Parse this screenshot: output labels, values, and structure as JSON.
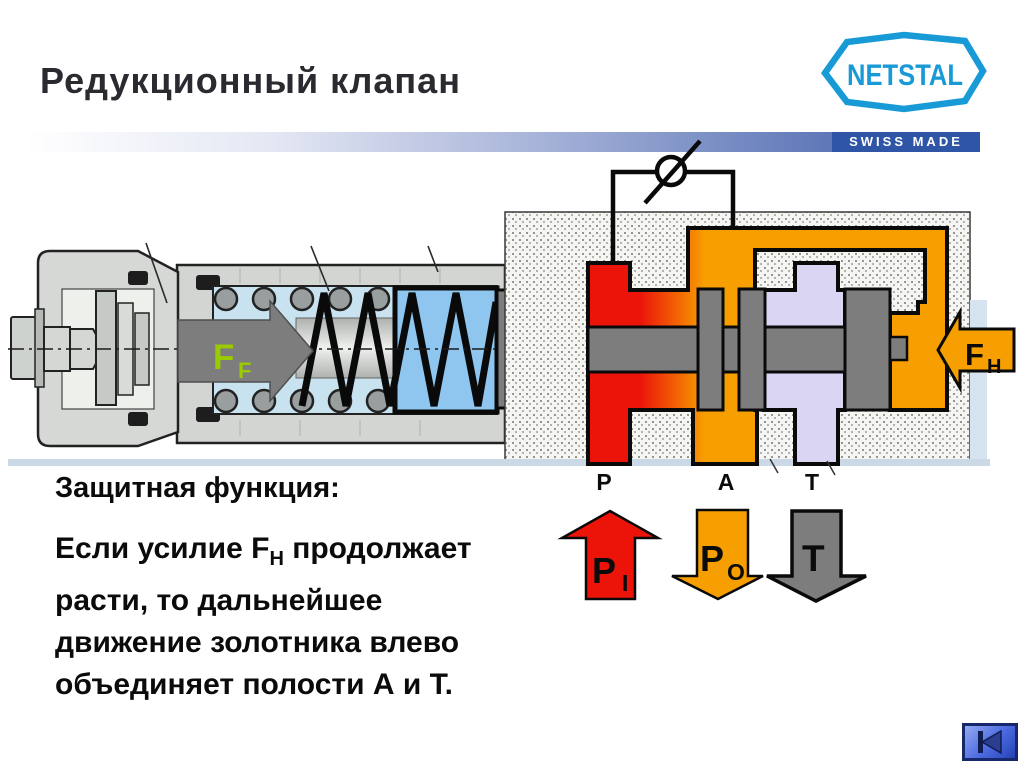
{
  "title": "Редукционный клапан",
  "logo": {
    "name": "NETSTAL",
    "tagline": "SWISS MADE"
  },
  "diagram": {
    "spring_force": {
      "base": "F",
      "sub": "F"
    },
    "hydraulic_force": {
      "base": "F",
      "sub": "H"
    },
    "ports": {
      "p": "P",
      "a": "A",
      "t": "T"
    },
    "arrows": {
      "inlet": {
        "base": "P",
        "sub": "I"
      },
      "outlet": {
        "base": "P",
        "sub": "O"
      },
      "tank": {
        "base": "T"
      }
    }
  },
  "protection": {
    "heading": "Защитная функция:",
    "line1_pre": "Если усилие F",
    "line1_sub": "H",
    "line1_post": " продолжает",
    "line2": "расти, то дальнейшее",
    "line3": "движение золотника влево",
    "line4": "объединяет полости А и Т."
  },
  "nav": {
    "icon": "skip-to-start"
  },
  "colors": {
    "brand_cyan": "#189ad6",
    "header_bar_blue": "#2e55a6",
    "pressure_red": "#ec1309",
    "pressure_orange": "#f79f00",
    "tank_purple": "#d9d5f3",
    "spool_gray": "#7d7d7d",
    "spring_blue": "#8ec6f0",
    "force_green": "#9acb00"
  }
}
